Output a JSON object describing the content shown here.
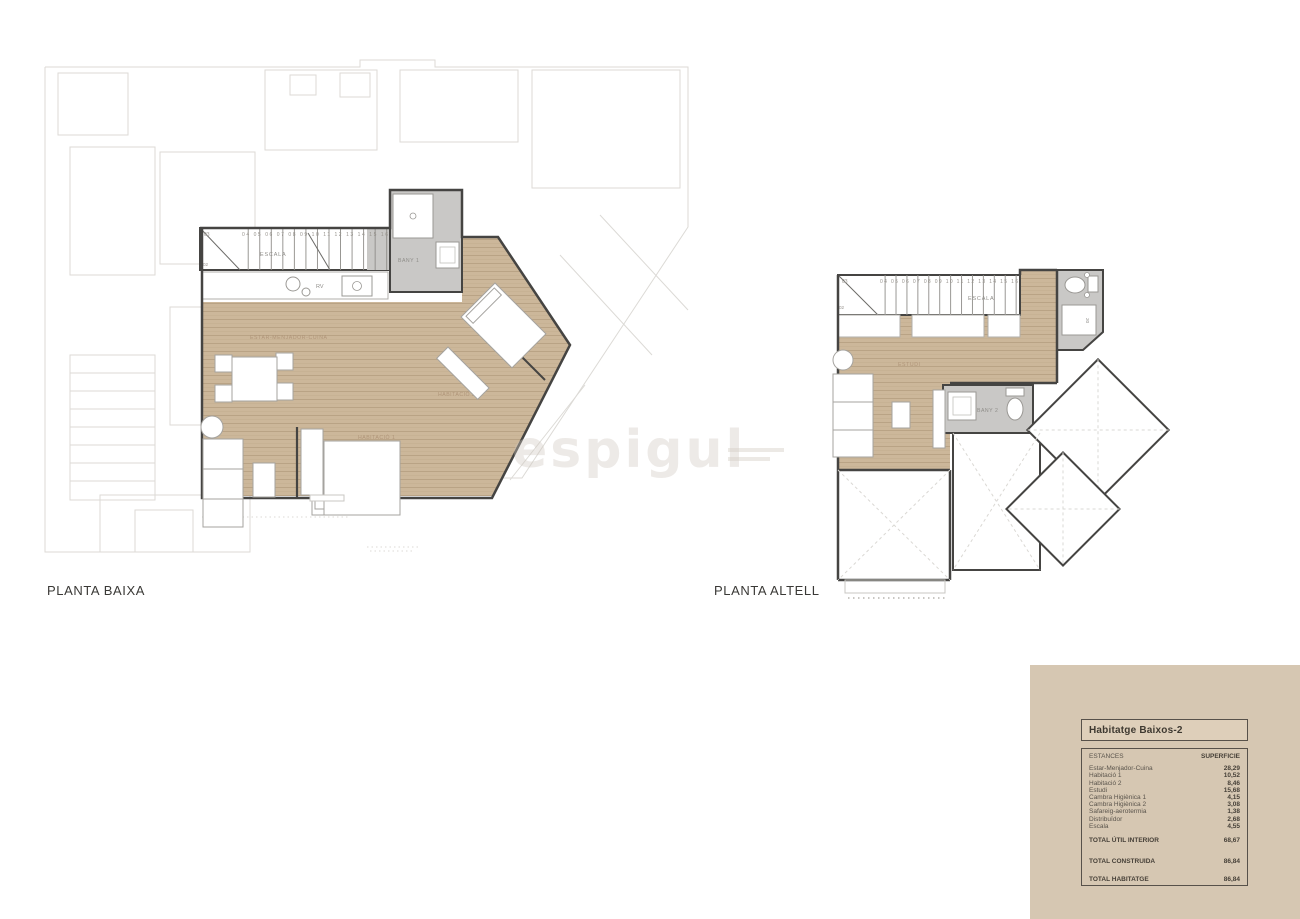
{
  "plans": {
    "baixa": {
      "label": "PLANTA BAIXA",
      "stair_label": "ESCALA",
      "stair_numbers": "04 05 06 07 08 09 10 11 12 13 14 15 16",
      "stair_num_03": "03",
      "stair_num_02": "02",
      "stair_num_01": "01",
      "rooms": {
        "living": "ESTAR-MENJADOR-CUINA",
        "bany1": "BANY 1",
        "hab1": "HABITACIÓ 1",
        "hab2": "HABITACIÓ 2",
        "kitchen_rv": "RV"
      }
    },
    "altell": {
      "label": "PLANTA ALTELL",
      "stair_label": "ESCALA",
      "stair_numbers": "04 05 06 07 08 09 10 11 12 13 14 15 16",
      "stair_num_03": "03",
      "stair_num_02": "02",
      "rooms": {
        "estudi": "ESTUDI",
        "bany2": "BANY 2",
        "box20": "20"
      }
    }
  },
  "watermark": {
    "text": "espigul"
  },
  "summary_table": {
    "title": "Habitatge Baixos-2",
    "col_estances": "ESTANCES",
    "col_superficie": "SUPERFICIE",
    "rows": [
      {
        "name": "Estar-Menjador-Cuina",
        "value": "28,29"
      },
      {
        "name": "Habitació 1",
        "value": "10,52"
      },
      {
        "name": "Habitació 2",
        "value": "8,46"
      },
      {
        "name": "Estudi",
        "value": "15,68"
      },
      {
        "name": "Cambra Higiènica 1",
        "value": "4,15"
      },
      {
        "name": "Cambra Higiènica 2",
        "value": "3,08"
      },
      {
        "name": "Safareig-aerotermia",
        "value": "1,38"
      },
      {
        "name": "Distribuïdor",
        "value": "2,68"
      },
      {
        "name": "Escala",
        "value": "4,55"
      }
    ],
    "totals": [
      {
        "name": "TOTAL ÚTIL INTERIOR",
        "value": "68,67"
      },
      {
        "name": "TOTAL CONSTRUIDA",
        "value": "86,84"
      },
      {
        "name": "TOTAL HABITATGE",
        "value": "86,84"
      }
    ],
    "colors": {
      "panel_bg": "#d6c7b2",
      "border": "#57514a",
      "wood": "#cbb698",
      "bath_floor": "#c9c8c6",
      "wall": "#454442",
      "faint_line": "#dcdad6"
    }
  }
}
